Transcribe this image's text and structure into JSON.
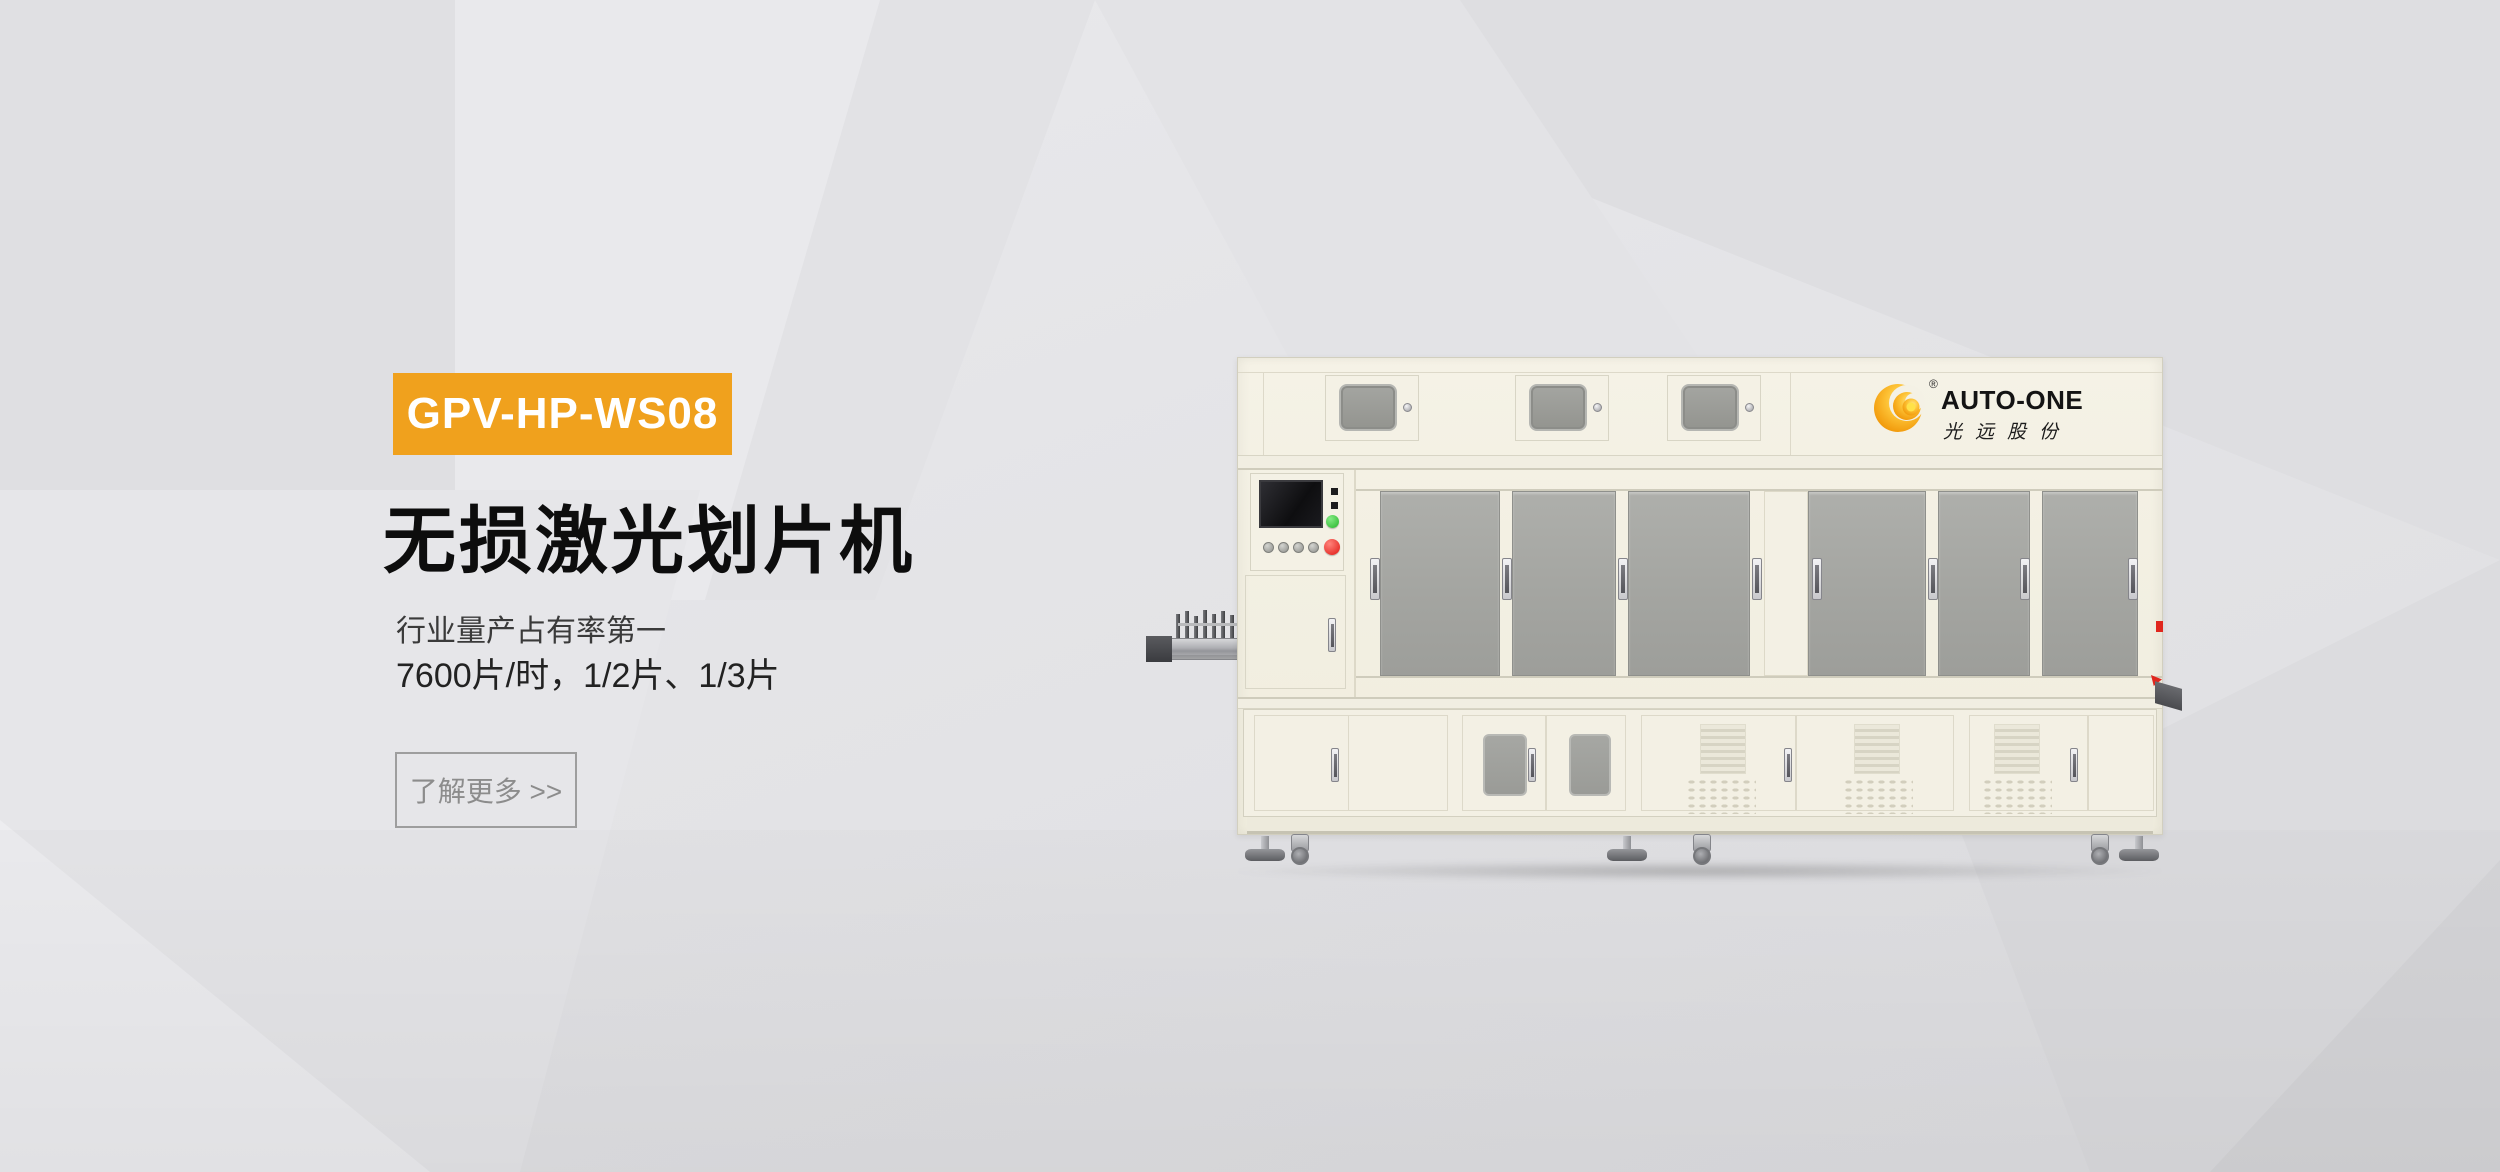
{
  "hero": {
    "model_badge": "GPV-HP-WS08",
    "title": "无损激光划片机",
    "subtitle_lines": [
      "行业量产占有率第一",
      "7600片/时，1/2片、1/3片"
    ],
    "cta_label": "了解更多 >>"
  },
  "machine": {
    "brand_en": "AUTO-ONE",
    "brand_cn": "光远股份",
    "trademark": "®",
    "logo_icon": "orange-swirl-crescent"
  },
  "colors": {
    "badge_bg": "#F0A11D",
    "badge_text": "#FFFFFF",
    "title_text": "#0D0D0D",
    "subtitle_text": "#2E2E2E",
    "cta_text": "#8C8C8C",
    "cta_border": "#9E9E9E",
    "background": "#E4E4E7",
    "machine_body": "#F3F0E4",
    "machine_door_gray": "#A6A7A3",
    "logo_orange": "#F6A203",
    "green_button": "#2FBD33",
    "red_button": "#E2221C"
  }
}
